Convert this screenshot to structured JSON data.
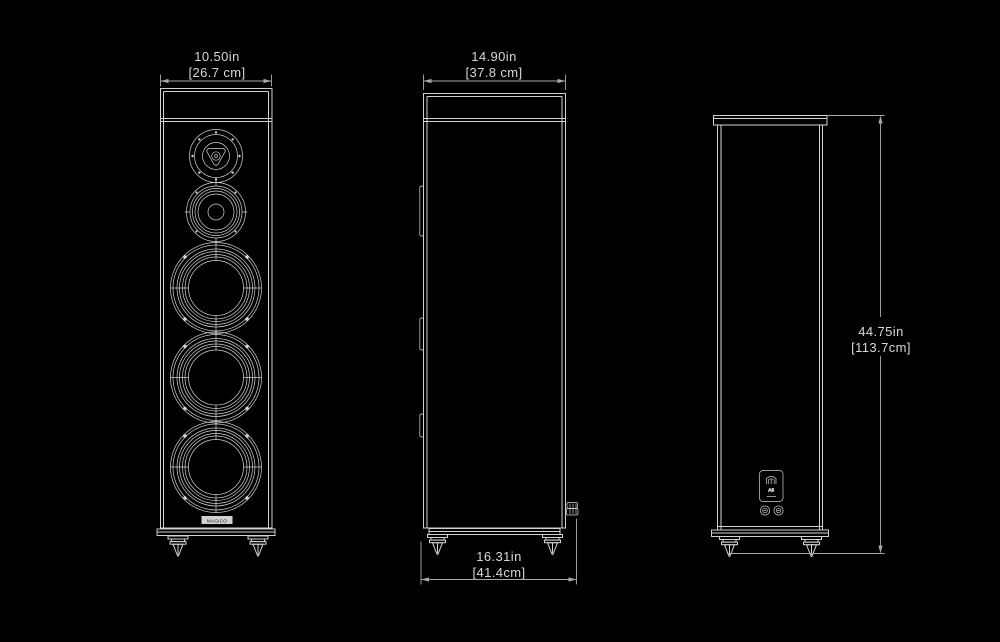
{
  "colors": {
    "background": "#000000",
    "line": "#d2d2d2",
    "line_dim": "#a9a9a9",
    "text": "#d8d8d8",
    "badge_text": "#111111"
  },
  "dimensions": {
    "front_width": {
      "inches": "10.50in",
      "metric": "[26.7 cm]"
    },
    "side_depth_top": {
      "inches": "14.90in",
      "metric": "[37.8 cm]"
    },
    "side_depth_bottom": {
      "inches": "16.31in",
      "metric": "[41.4cm]"
    },
    "back_height": {
      "inches": "44.75in",
      "metric": "[113.7cm]"
    }
  },
  "labels": {
    "front_badge": "MAGICO",
    "rear_plate_model": "A5"
  },
  "icons": {
    "rear_plate_logo": "magico-crest",
    "front_drivers": [
      "tweeter",
      "midrange",
      "woofer",
      "woofer",
      "woofer"
    ]
  }
}
